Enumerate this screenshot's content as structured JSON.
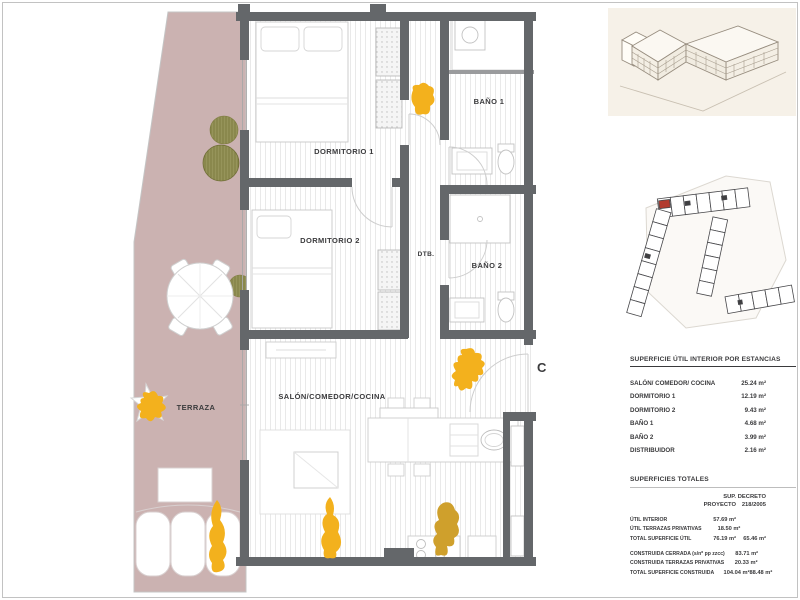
{
  "plan": {
    "unit_letter": "C",
    "rooms": {
      "dormitorio1": "DORMITORIO 1",
      "dormitorio2": "DORMITORIO 2",
      "bano1": "BAÑO 1",
      "bano2": "BAÑO 2",
      "dtb": "DTB.",
      "salon": "SALÓN/COMEDOR/COCINA",
      "terraza": "TERRAZA"
    },
    "colors": {
      "wall": "#64676a",
      "terrace_floor": "#cbb2b1",
      "highlight_blob": "#f3b11d",
      "highlight_blob_dark": "#cfa02c",
      "plant": "#8e8c4a",
      "render_background": "#f6f1e8",
      "keyplan_unit_marker": "#b23b2f"
    }
  },
  "tables": {
    "estancias": {
      "title": "SUPERFICIE ÚTIL INTERIOR POR ESTANCIAS",
      "rows": [
        {
          "label": "SALÓN/ COMEDOR/ COCINA",
          "value": "25.24 m²"
        },
        {
          "label": "DORMITORIO 1",
          "value": "12.19 m²"
        },
        {
          "label": "DORMITORIO 2",
          "value": "9.43 m²"
        },
        {
          "label": "BAÑO 1",
          "value": "4.68 m²"
        },
        {
          "label": "BAÑO 2",
          "value": "3.99 m²"
        },
        {
          "label": "DISTRIBUIDOR",
          "value": "2.16 m²"
        }
      ]
    },
    "totales": {
      "title": "SUPERFICIES TOTALES",
      "col1_line1": "SUP.",
      "col1_line2": "PROYECTO",
      "col2_line1": "DECRETO",
      "col2_line2": "218/2005",
      "rows": [
        {
          "label": "ÚTIL INTERIOR",
          "v1": "57.69 m²",
          "v2": ""
        },
        {
          "label": "ÚTIL TERRAZAS PRIVATIVAS",
          "v1": "18.50 m²",
          "v2": ""
        },
        {
          "label": "TOTAL SUPERFICIE ÚTIL",
          "v1": "76.19 m²",
          "v2": "65.46 m²"
        },
        {
          "label": "CONSTRUIDA CERRADA (s/nº pp zzcc)",
          "v1": "83.71 m²",
          "v2": ""
        },
        {
          "label": "CONSTRUIDA TERRAZAS PRIVATIVAS",
          "v1": "20.33 m²",
          "v2": ""
        },
        {
          "label": "TOTAL SUPERFICIE CONSTRUIDA",
          "v1": "104.04 m²",
          "v2": "88.48 m²"
        }
      ]
    }
  }
}
